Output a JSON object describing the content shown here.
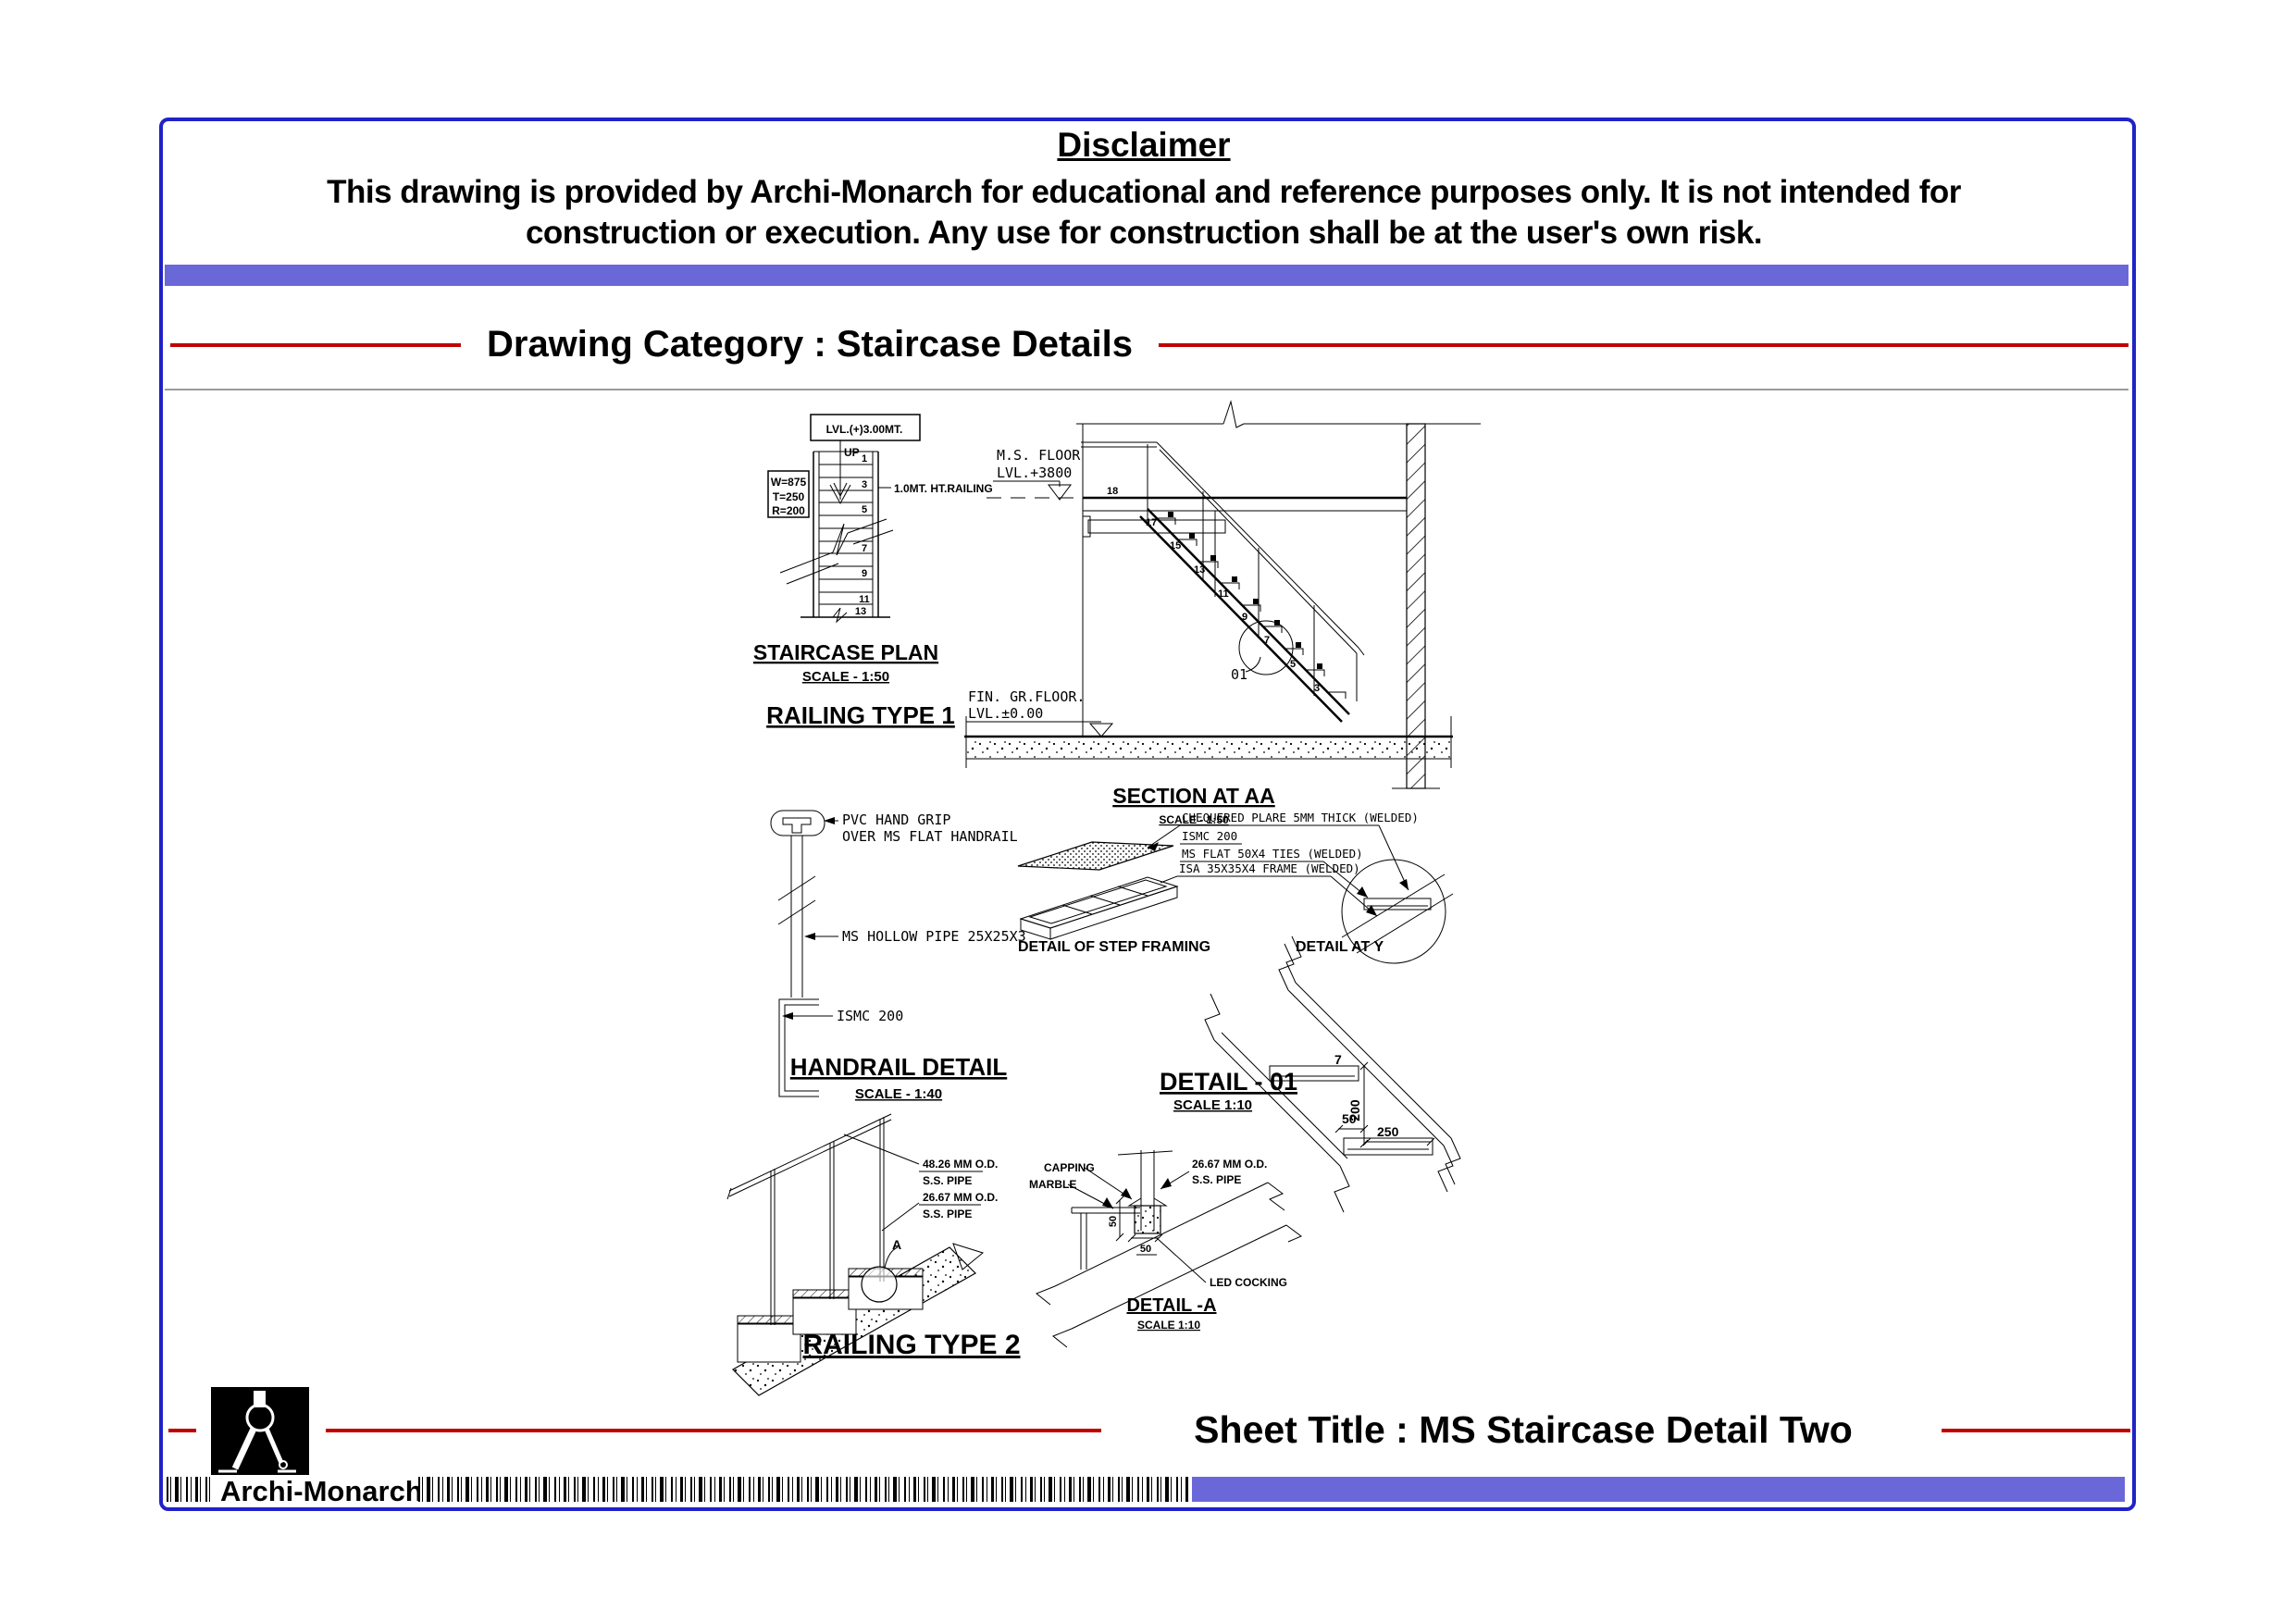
{
  "page": {
    "disclaimer_title": "Disclaimer",
    "disclaimer_line1": "This drawing is provided by Archi-Monarch for educational and reference purposes only. It is not intended for",
    "disclaimer_line2": "construction or execution. Any use for construction shall be at the user's own risk.",
    "category_heading": "Drawing Category : Staircase Details"
  },
  "footer": {
    "brand": "Archi-Monarch",
    "sheet_title": "Sheet Title : MS Staircase Detail Two"
  },
  "colors": {
    "accent_red": "#c00000",
    "bar_purple": "#6a68d8",
    "border_blue": "#2022c8"
  },
  "drawings": {
    "staircase_plan": {
      "level_box": "LVL.(+)3.00MT.",
      "up_label": "UP",
      "dims_box": [
        "W=875",
        "T=250",
        "R=200"
      ],
      "railing_note": "1.0MT. HT.RAILING",
      "steps": [
        "1",
        "3",
        "5",
        "7",
        "9",
        "11",
        "13"
      ],
      "title": "STAIRCASE PLAN",
      "scale": "SCALE - 1:50",
      "railing_type1": "RAILING TYPE 1"
    },
    "section": {
      "floor_label1": "M.S. FLOOR",
      "floor_label2": "LVL.+3800",
      "ground_label1": "FIN. GR.FLOOR.",
      "ground_label2": "LVL.±0.00",
      "steps": [
        "18",
        "17",
        "15",
        "13",
        "11",
        "9",
        "7",
        "5",
        "3"
      ],
      "detail_marker": "01",
      "title": "SECTION AT AA",
      "scale": "SCALE - 1:50"
    },
    "handrail": {
      "grip_note1": "PVC HAND GRIP",
      "grip_note2": "OVER MS FLAT HANDRAIL",
      "pipe_note": "MS HOLLOW PIPE 25X25X3",
      "ismc_note": "ISMC 200",
      "title": "HANDRAIL DETAIL",
      "scale": "SCALE - 1:40"
    },
    "step_framing": {
      "note1": "CHEQUERED PLARE 5MM THICK (WELDED)",
      "note2": "ISMC 200",
      "note3": "MS FLAT 50X4 TIES (WELDED)",
      "note4": "ISA 35X35X4 FRAME  (WELDED)",
      "title": "DETAIL OF STEP FRAMING"
    },
    "detail_y": {
      "title": "DETAIL AT Y"
    },
    "detail_01": {
      "title": "DETAIL - 01",
      "scale": "SCALE 1:10",
      "dim_7": "7",
      "dim_200": "200",
      "dim_50": "50",
      "dim_250": "250"
    },
    "railing2": {
      "pipe1_line1": "48.26 MM O.D.",
      "pipe1_line2": "S.S. PIPE",
      "pipe2_line1": "26.67 MM O.D.",
      "pipe2_line2": "S.S. PIPE",
      "marker": "A",
      "title": "RAILING TYPE 2"
    },
    "detail_a": {
      "capping": "CAPPING",
      "marble": "MARBLE",
      "pipe_line1": "26.67 MM O.D.",
      "pipe_line2": "S.S. PIPE",
      "led": "LED COCKING",
      "dim_50v": "50",
      "dim_50h": "50",
      "title": "DETAIL -A",
      "scale": "SCALE 1:10"
    }
  }
}
